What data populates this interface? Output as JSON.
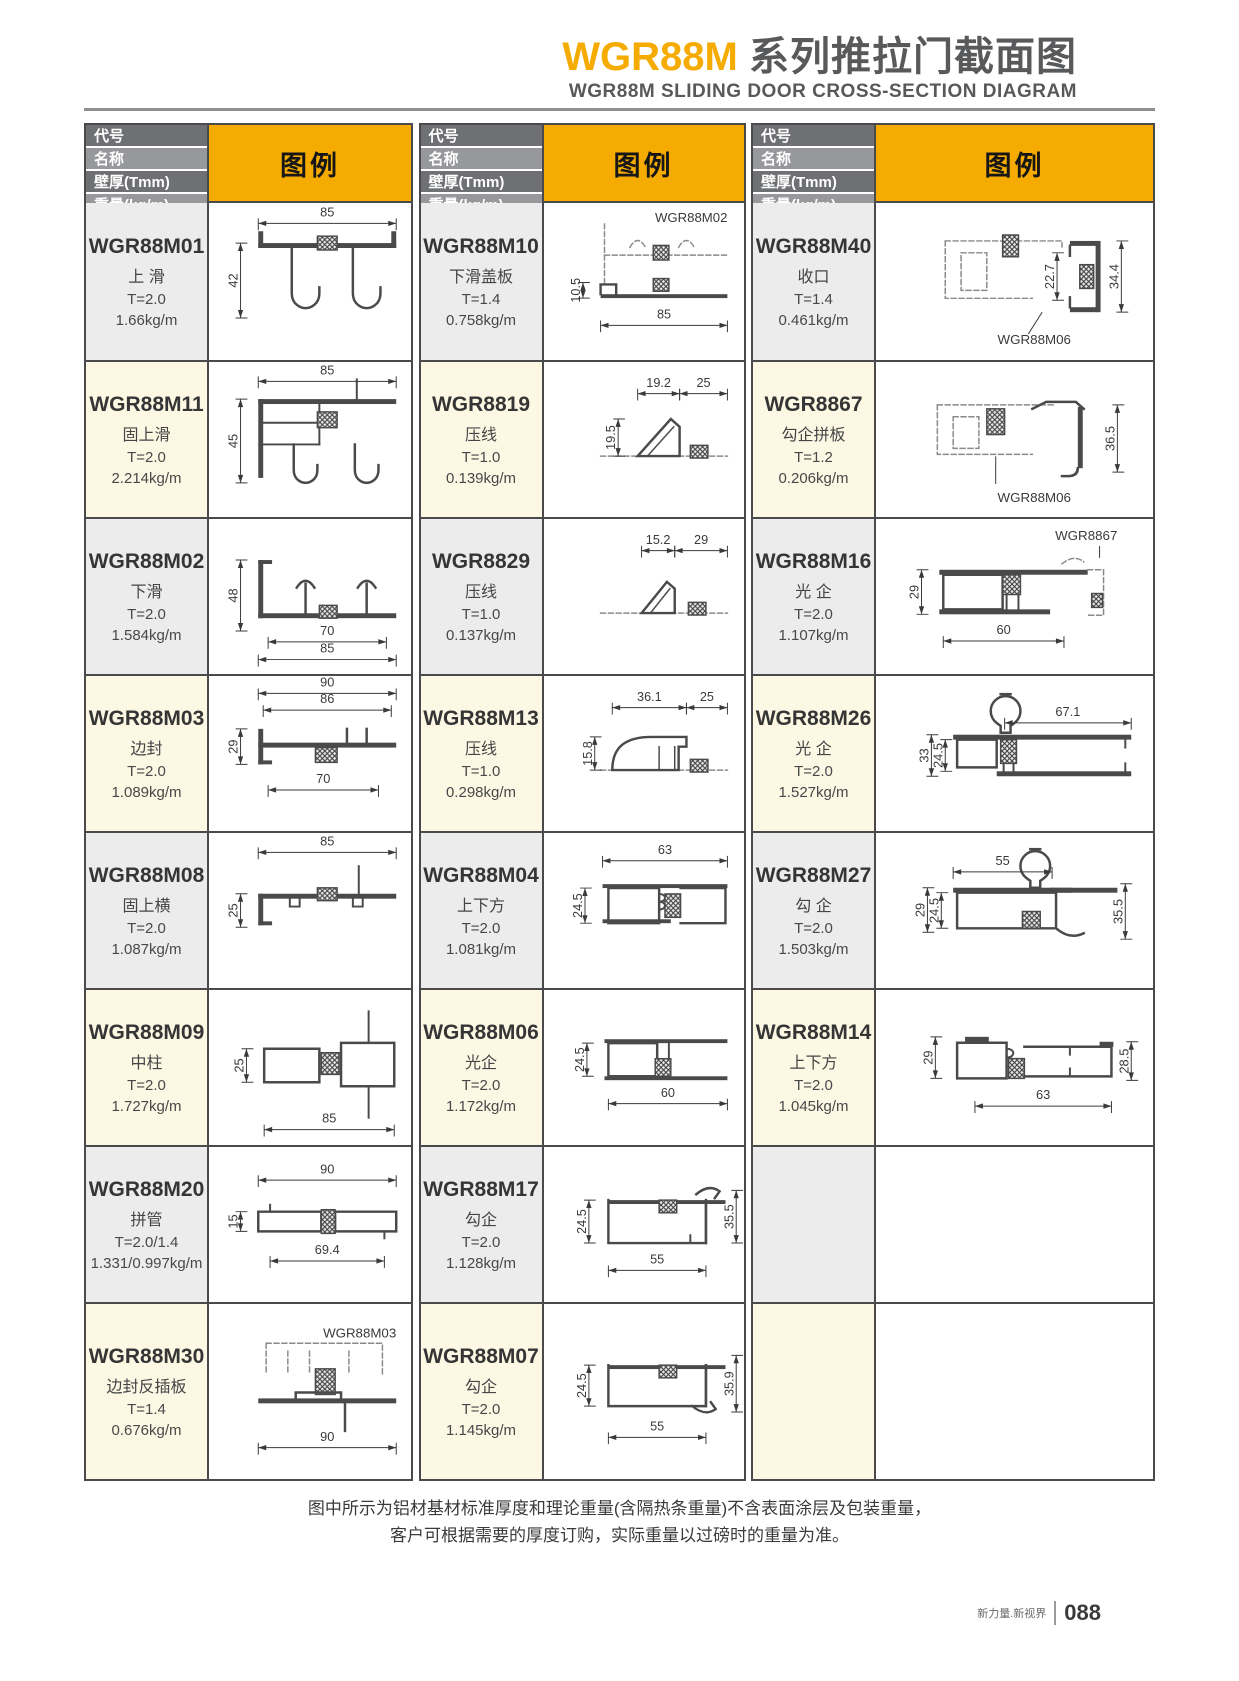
{
  "page": {
    "title_code": "WGR88M",
    "title_cn": "系列推拉门截面图",
    "subtitle": "WGR88M SLIDING DOOR CROSS-SECTION DIAGRAM",
    "note_line1": "图中所示为铝材基材标准厚度和理论重量(含隔热条重量)不含表面涂层及包装重量，",
    "note_line2": "客户可根据需要的厚度订购，实际重量以过磅时的重量为准。",
    "brand": "新力量.新视界",
    "page_number": "088"
  },
  "header": {
    "row_labels": [
      "代号",
      "名称",
      "壁厚(Tmm)",
      "重量(kg/m)"
    ],
    "legend_label": "图例"
  },
  "colors": {
    "accent": "#f5ab00",
    "header_bar_dark": "#6f7073",
    "header_bar_light": "#97989b",
    "row_gray": "#ececec",
    "row_cream": "#fcf8e3",
    "border": "#4a4a4c",
    "profile_stroke": "#4a4a4c",
    "dashed_reference": "#8a8a8a",
    "dim_text": "#3a3a3b"
  },
  "columns": [
    {
      "rows": [
        {
          "code": "WGR88M01",
          "name": "上 滑",
          "thickness": "T=2.0",
          "weight": "1.66kg/m",
          "dims": [
            "85",
            "42"
          ],
          "ref": ""
        },
        {
          "code": "WGR88M11",
          "name": "固上滑",
          "thickness": "T=2.0",
          "weight": "2.214kg/m",
          "dims": [
            "85",
            "45"
          ],
          "ref": ""
        },
        {
          "code": "WGR88M02",
          "name": "下滑",
          "thickness": "T=2.0",
          "weight": "1.584kg/m",
          "dims": [
            "48",
            "70",
            "85"
          ],
          "ref": ""
        },
        {
          "code": "WGR88M03",
          "name": "边封",
          "thickness": "T=2.0",
          "weight": "1.089kg/m",
          "dims": [
            "90",
            "86",
            "29",
            "70"
          ],
          "ref": ""
        },
        {
          "code": "WGR88M08",
          "name": "固上横",
          "thickness": "T=2.0",
          "weight": "1.087kg/m",
          "dims": [
            "85",
            "25"
          ],
          "ref": ""
        },
        {
          "code": "WGR88M09",
          "name": "中柱",
          "thickness": "T=2.0",
          "weight": "1.727kg/m",
          "dims": [
            "25",
            "85"
          ],
          "ref": ""
        },
        {
          "code": "WGR88M20",
          "name": "拼管",
          "thickness": "T=2.0/1.4",
          "weight": "1.331/0.997kg/m",
          "dims": [
            "90",
            "15",
            "69.4"
          ],
          "ref": ""
        },
        {
          "code": "WGR88M30",
          "name": "边封反插板",
          "thickness": "T=1.4",
          "weight": "0.676kg/m",
          "dims": [
            "90"
          ],
          "ref": "WGR88M03"
        }
      ]
    },
    {
      "rows": [
        {
          "code": "WGR88M10",
          "name": "下滑盖板",
          "thickness": "T=1.4",
          "weight": "0.758kg/m",
          "dims": [
            "10.5",
            "85"
          ],
          "ref": "WGR88M02"
        },
        {
          "code": "WGR8819",
          "name": "压线",
          "thickness": "T=1.0",
          "weight": "0.139kg/m",
          "dims": [
            "19.2",
            "25",
            "19.5"
          ],
          "ref": ""
        },
        {
          "code": "WGR8829",
          "name": "压线",
          "thickness": "T=1.0",
          "weight": "0.137kg/m",
          "dims": [
            "15.2",
            "29"
          ],
          "ref": ""
        },
        {
          "code": "WGR88M13",
          "name": "压线",
          "thickness": "T=1.0",
          "weight": "0.298kg/m",
          "dims": [
            "36.1",
            "25",
            "15.8"
          ],
          "ref": ""
        },
        {
          "code": "WGR88M04",
          "name": "上下方",
          "thickness": "T=2.0",
          "weight": "1.081kg/m",
          "dims": [
            "63",
            "24.5"
          ],
          "ref": ""
        },
        {
          "code": "WGR88M06",
          "name": "光企",
          "thickness": "T=2.0",
          "weight": "1.172kg/m",
          "dims": [
            "24.5",
            "60"
          ],
          "ref": ""
        },
        {
          "code": "WGR88M17",
          "name": "勾企",
          "thickness": "T=2.0",
          "weight": "1.128kg/m",
          "dims": [
            "24.5",
            "55",
            "35.5"
          ],
          "ref": ""
        },
        {
          "code": "WGR88M07",
          "name": "勾企",
          "thickness": "T=2.0",
          "weight": "1.145kg/m",
          "dims": [
            "24.5",
            "55",
            "35.9"
          ],
          "ref": ""
        }
      ]
    },
    {
      "rows": [
        {
          "code": "WGR88M40",
          "name": "收口",
          "thickness": "T=1.4",
          "weight": "0.461kg/m",
          "dims": [
            "22.7",
            "34.4"
          ],
          "ref": "WGR88M06"
        },
        {
          "code": "WGR8867",
          "name": "勾企拼板",
          "thickness": "T=1.2",
          "weight": "0.206kg/m",
          "dims": [
            "36.5"
          ],
          "ref": "WGR88M06"
        },
        {
          "code": "WGR88M16",
          "name": "光 企",
          "thickness": "T=2.0",
          "weight": "1.107kg/m",
          "dims": [
            "29",
            "60"
          ],
          "ref": "WGR8867"
        },
        {
          "code": "WGR88M26",
          "name": "光 企",
          "thickness": "T=2.0",
          "weight": "1.527kg/m",
          "dims": [
            "67.1",
            "33",
            "24.5"
          ],
          "ref": ""
        },
        {
          "code": "WGR88M27",
          "name": "勾 企",
          "thickness": "T=2.0",
          "weight": "1.503kg/m",
          "dims": [
            "55",
            "29",
            "24.5",
            "35.5"
          ],
          "ref": ""
        },
        {
          "code": "WGR88M14",
          "name": "上下方",
          "thickness": "T=2.0",
          "weight": "1.045kg/m",
          "dims": [
            "29",
            "28.5",
            "63"
          ],
          "ref": ""
        },
        {
          "code": "",
          "name": "",
          "thickness": "",
          "weight": "",
          "dims": [],
          "ref": ""
        },
        {
          "code": "",
          "name": "",
          "thickness": "",
          "weight": "",
          "dims": [],
          "ref": ""
        }
      ]
    }
  ]
}
